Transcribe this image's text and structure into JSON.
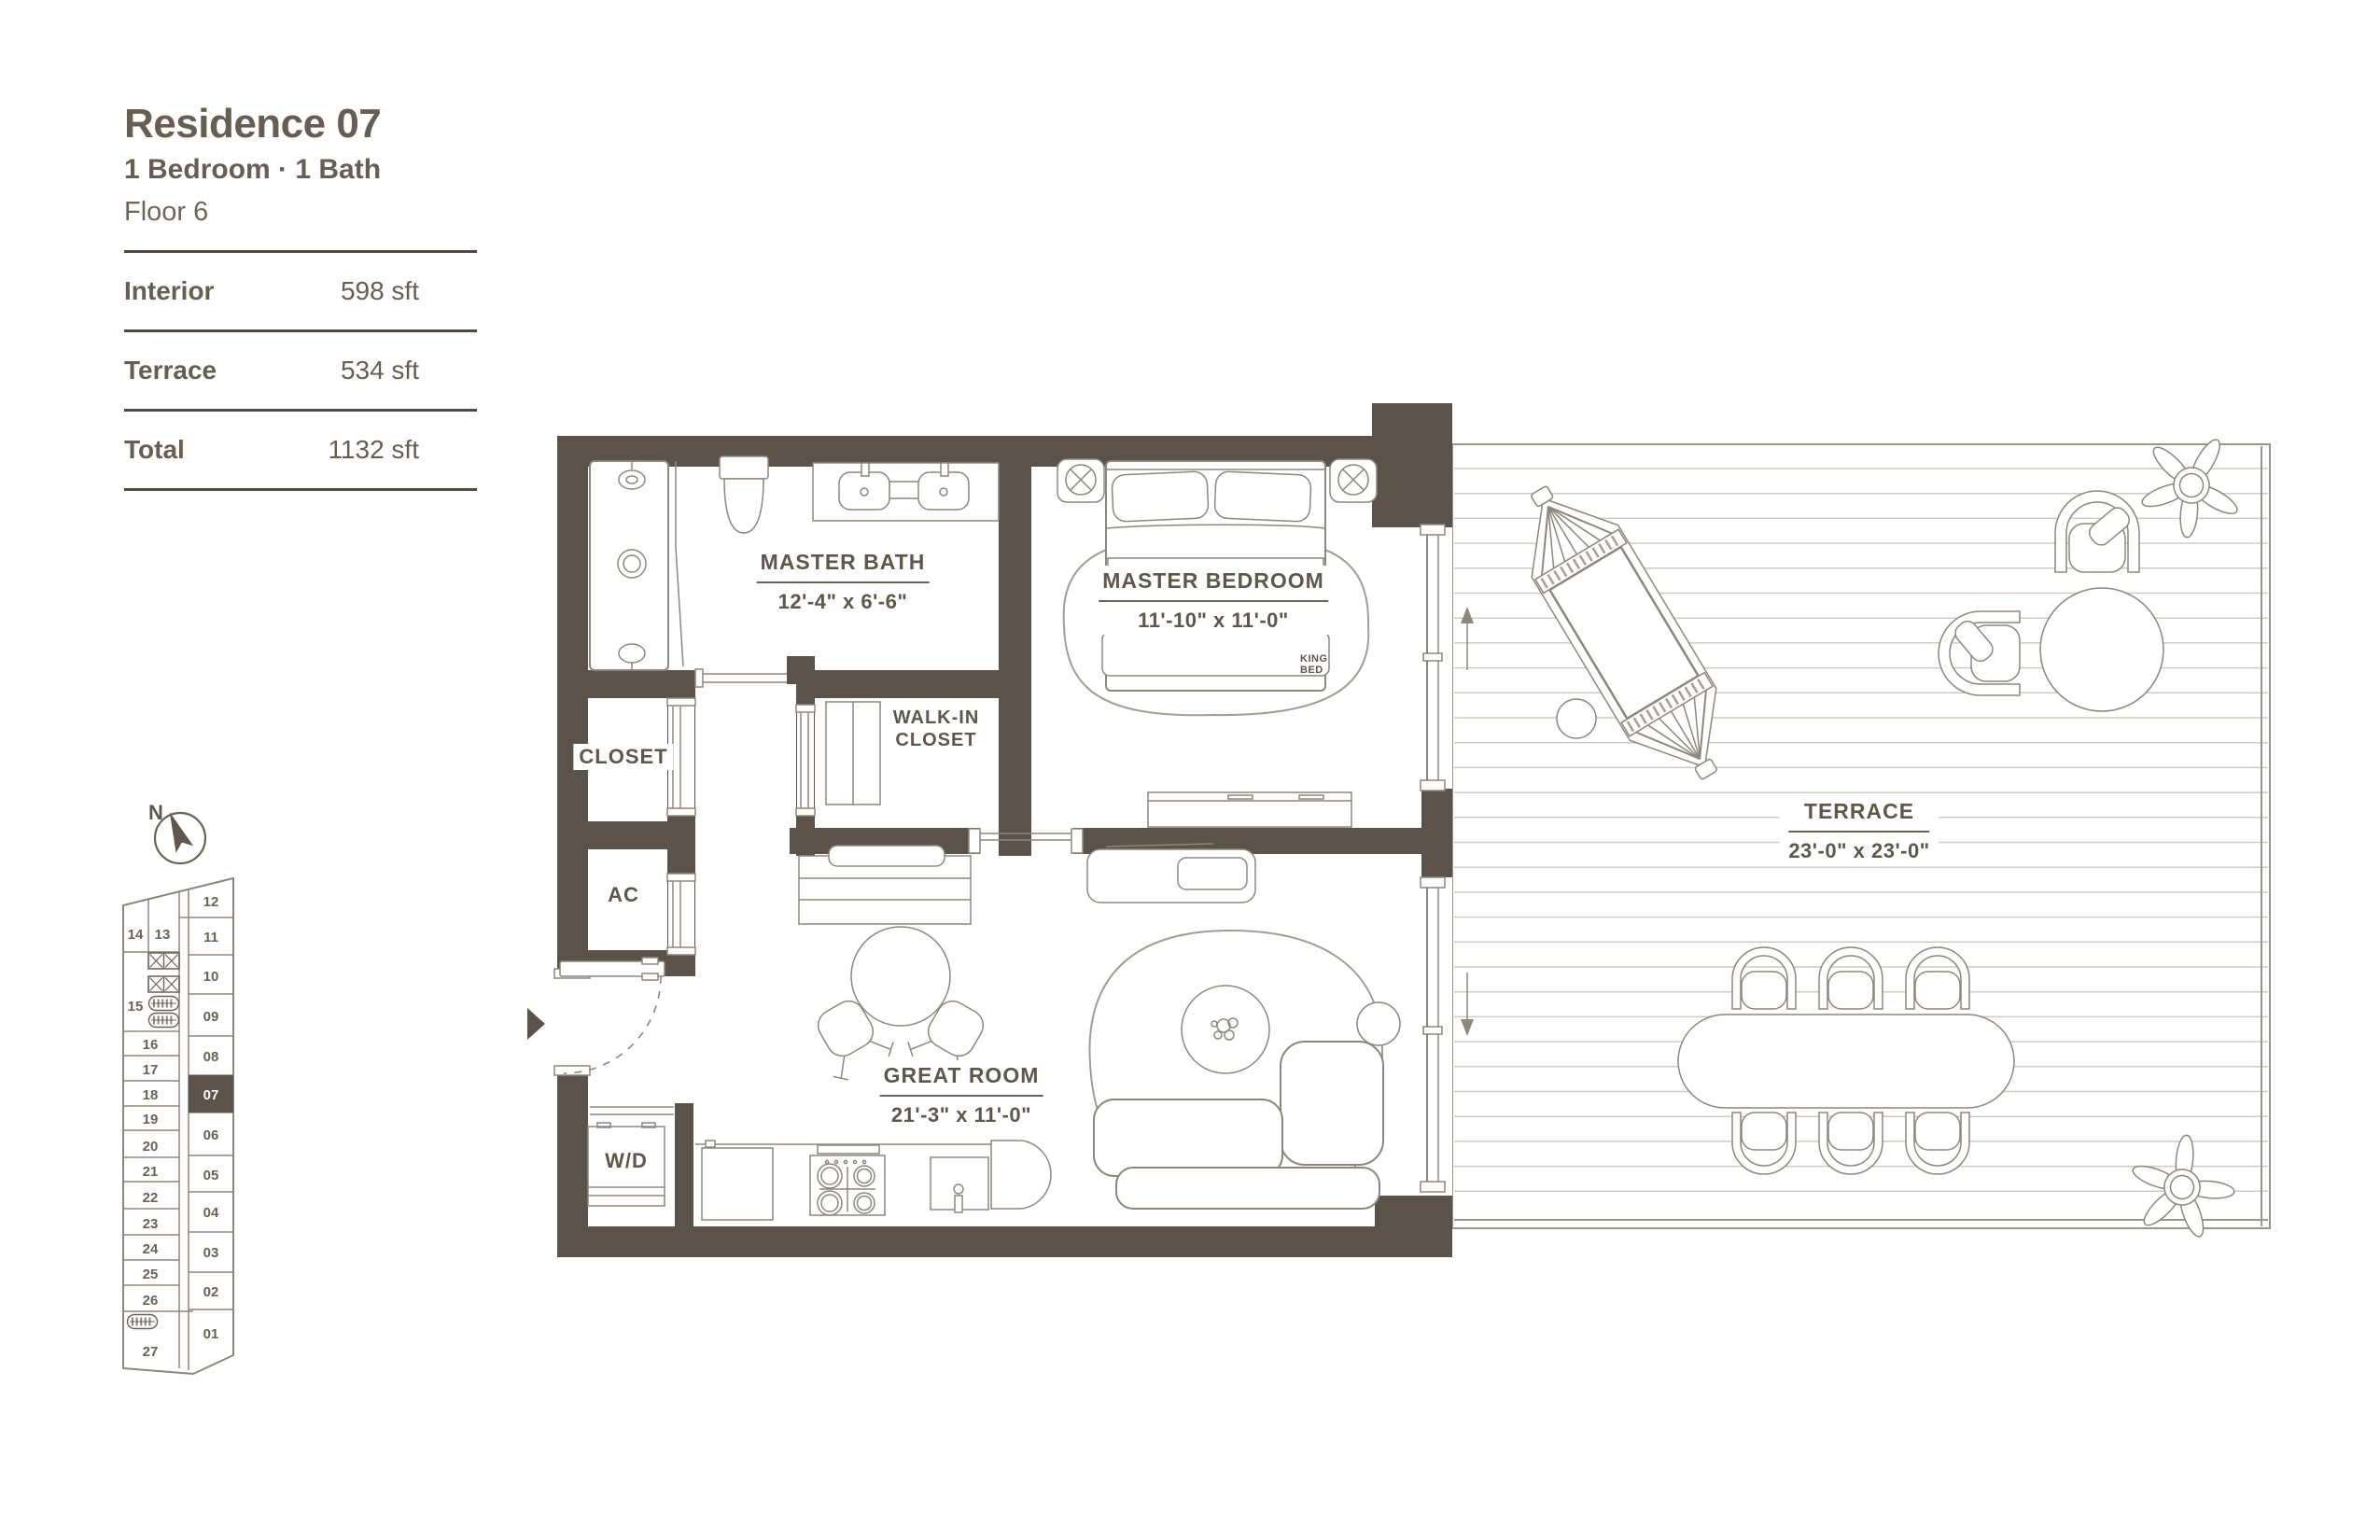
{
  "unit": {
    "title": "Residence 07",
    "subtitle": "1 Bedroom · 1 Bath",
    "floor": "Floor 6",
    "areas": [
      {
        "label": "Interior",
        "value": "598 sft"
      },
      {
        "label": "Terrace",
        "value": "534 sft"
      },
      {
        "label": "Total",
        "value": "1132 sft"
      }
    ]
  },
  "compass": {
    "north_label": "N"
  },
  "keyplan": {
    "highlighted_unit": "07",
    "units": [
      "01",
      "02",
      "03",
      "04",
      "05",
      "06",
      "07",
      "08",
      "09",
      "10",
      "11",
      "12",
      "13",
      "14",
      "15",
      "16",
      "17",
      "18",
      "19",
      "20",
      "21",
      "22",
      "23",
      "24",
      "25",
      "26",
      "27"
    ]
  },
  "rooms": {
    "master_bath": {
      "name": "MASTER BATH",
      "dims": "12'-4\" x 6'-6\""
    },
    "master_bedroom": {
      "name": "MASTER BEDROOM",
      "dims": "11'-10\" x 11'-0\""
    },
    "great_room": {
      "name": "GREAT ROOM",
      "dims": "21'-3\" x 11'-0\""
    },
    "terrace": {
      "name": "TERRACE",
      "dims": "23'-0\" x 23'-0\""
    },
    "walk_in_closet": {
      "line1": "WALK-IN",
      "line2": "CLOSET"
    },
    "closet": {
      "name": "CLOSET"
    },
    "ac": {
      "name": "AC"
    },
    "washer_dryer": {
      "name": "W/D"
    },
    "king_bed": {
      "line1": "KING",
      "line2": "BED"
    }
  },
  "colors": {
    "wall": "#5b5349",
    "ink": "#675d52",
    "line": "#8d867c",
    "plank": "#cfcbc4"
  }
}
